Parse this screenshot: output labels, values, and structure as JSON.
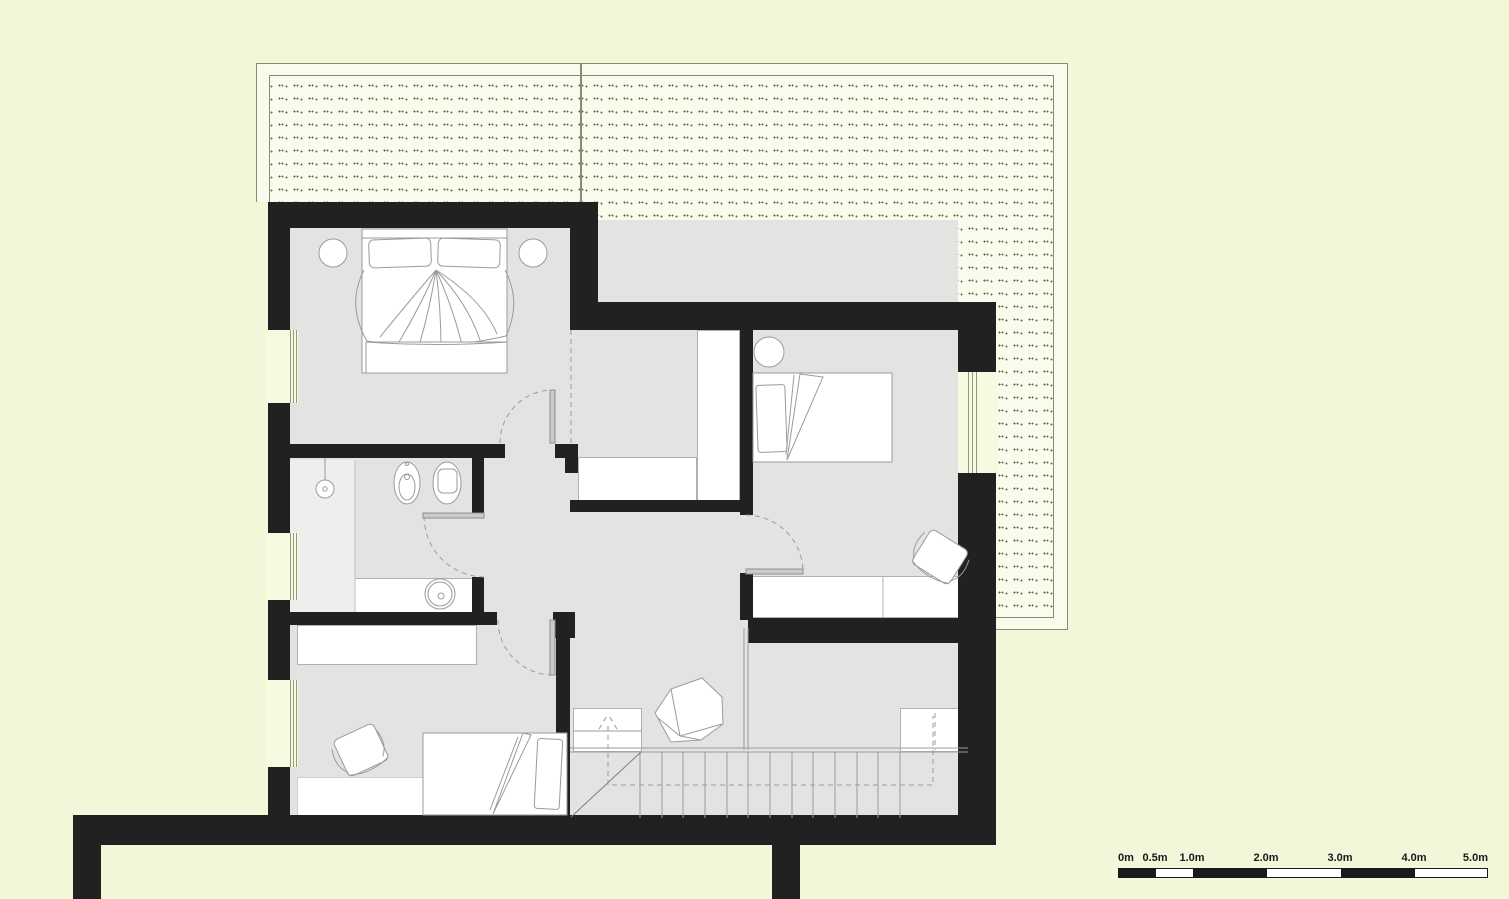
{
  "drawing": {
    "type": "architectural-floor-plan",
    "floor": "upper floor with pitched roof / roof deck shown dotted",
    "objects": [
      "roof-area-dotted",
      "master-bedroom",
      "bathroom",
      "bedroom-right",
      "bedroom-bottom",
      "hallway-landing",
      "staircase",
      "double-bed",
      "single-bed",
      "bedside-lamp",
      "toilet",
      "bidet",
      "washbasin",
      "shower-head",
      "desk-chair",
      "armchair",
      "wardrobe",
      "door-swing",
      "window",
      "stair-walk-line-arrow"
    ]
  },
  "scale_bar": {
    "labels": [
      "0m",
      "0.5m",
      "1.0m",
      "2.0m",
      "3.0m",
      "4.0m",
      "5.0m"
    ],
    "units": "meters",
    "segments_px": [
      37,
      37,
      74,
      74,
      74,
      74
    ]
  },
  "colors": {
    "page_bg": "#f1f8da",
    "roof_bg": "#f9fcec",
    "roof_line": "#8a8a70",
    "wall": "#212121",
    "room": "#e3e3e2",
    "room_light": "#eeeeed",
    "white": "#ffffff",
    "line": "#9b9b9b",
    "door": "#cbcbcb",
    "scale": "#1a1a1a"
  }
}
